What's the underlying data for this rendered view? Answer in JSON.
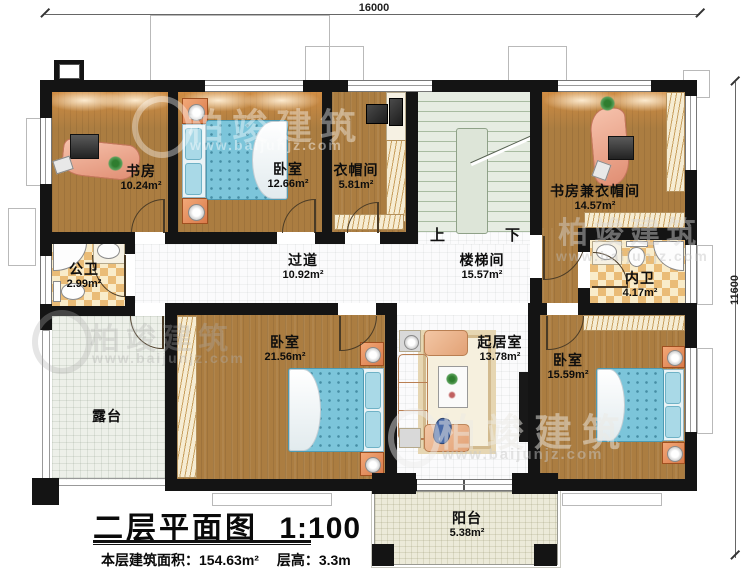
{
  "dimensions": {
    "top": "16000",
    "right": "11600"
  },
  "rooms": {
    "study": {
      "name": "书房",
      "area": "10.24m²"
    },
    "bedroom_top": {
      "name": "卧室",
      "area": "12.66m²"
    },
    "cloakroom": {
      "name": "衣帽间",
      "area": "5.81m²"
    },
    "study_cloak": {
      "name": "书房兼衣帽间",
      "area": "14.57m²"
    },
    "public_bath": {
      "name": "公卫",
      "area": "2.99m²"
    },
    "corridor": {
      "name": "过道",
      "area": "10.92m²"
    },
    "stairwell": {
      "name": "楼梯间",
      "area": "15.57m²"
    },
    "inner_bath": {
      "name": "内卫",
      "area": "4.17m²"
    },
    "bedroom_left": {
      "name": "卧室",
      "area": "21.56m²"
    },
    "living": {
      "name": "起居室",
      "area": "13.78m²"
    },
    "bedroom_right": {
      "name": "卧室",
      "area": "15.59m²"
    },
    "terrace": {
      "name": "露台"
    },
    "balcony": {
      "name": "阳台",
      "area": "5.38m²"
    }
  },
  "stairs": {
    "up": "上",
    "down": "下"
  },
  "titleblock": {
    "title": "二层平面图",
    "scale": "1:100",
    "area_label": "本层建筑面积：",
    "area_value": "154.63m²",
    "height_label": "层高：",
    "height_value": "3.3m"
  },
  "watermark": {
    "brand": "柏竣建筑",
    "url": "www.baijunjz.com"
  },
  "colors": {
    "wall": "#141414",
    "wood": "#ab7d41",
    "tile_dark": "#eabc77",
    "tile_light": "#f9ecca",
    "bed": "#7cc5da",
    "stairs": "#e6ece2",
    "desk": "#efab8e"
  }
}
